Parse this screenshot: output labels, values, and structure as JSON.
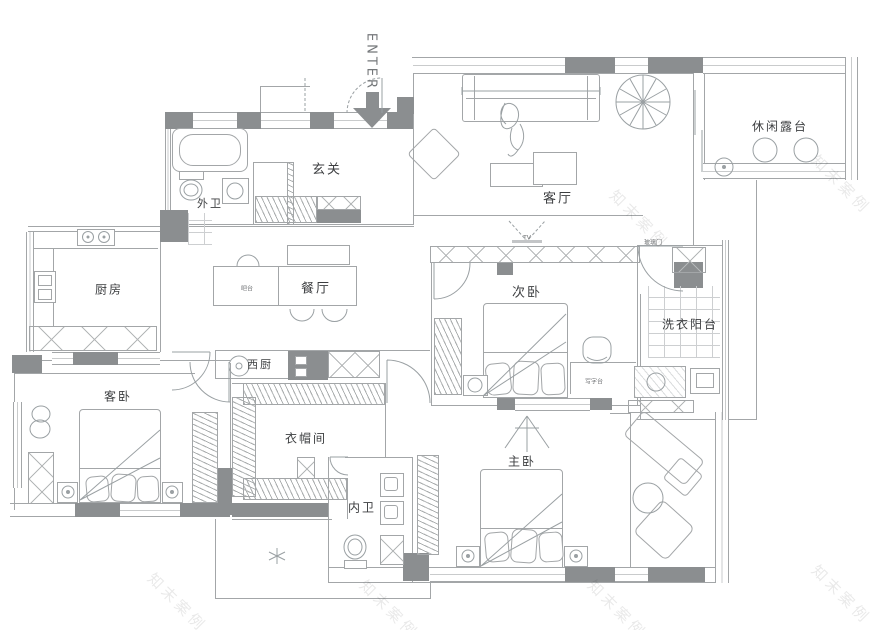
{
  "labels": {
    "enter": "ENTER",
    "entry_hall": "玄关",
    "guest_bath": "外卫",
    "living_room": "客厅",
    "terrace": "休闲露台",
    "kitchen": "厨房",
    "dining": "餐厅",
    "bar": "吧台",
    "second_bedroom": "次卧",
    "laundry_balcony": "洗衣阳台",
    "glass_door": "玻璃门",
    "desk": "写字台",
    "guest_bedroom": "客卧",
    "west_kitchen": "西厨",
    "cloakroom": "衣帽间",
    "master_bedroom": "主卧",
    "master_bath": "内卫",
    "tv": "TV"
  },
  "watermark": {
    "text": "知末案例"
  },
  "colors": {
    "wall_fill": "#8b8e90",
    "line": "#a3a6a8",
    "label": "#3c3e40"
  }
}
